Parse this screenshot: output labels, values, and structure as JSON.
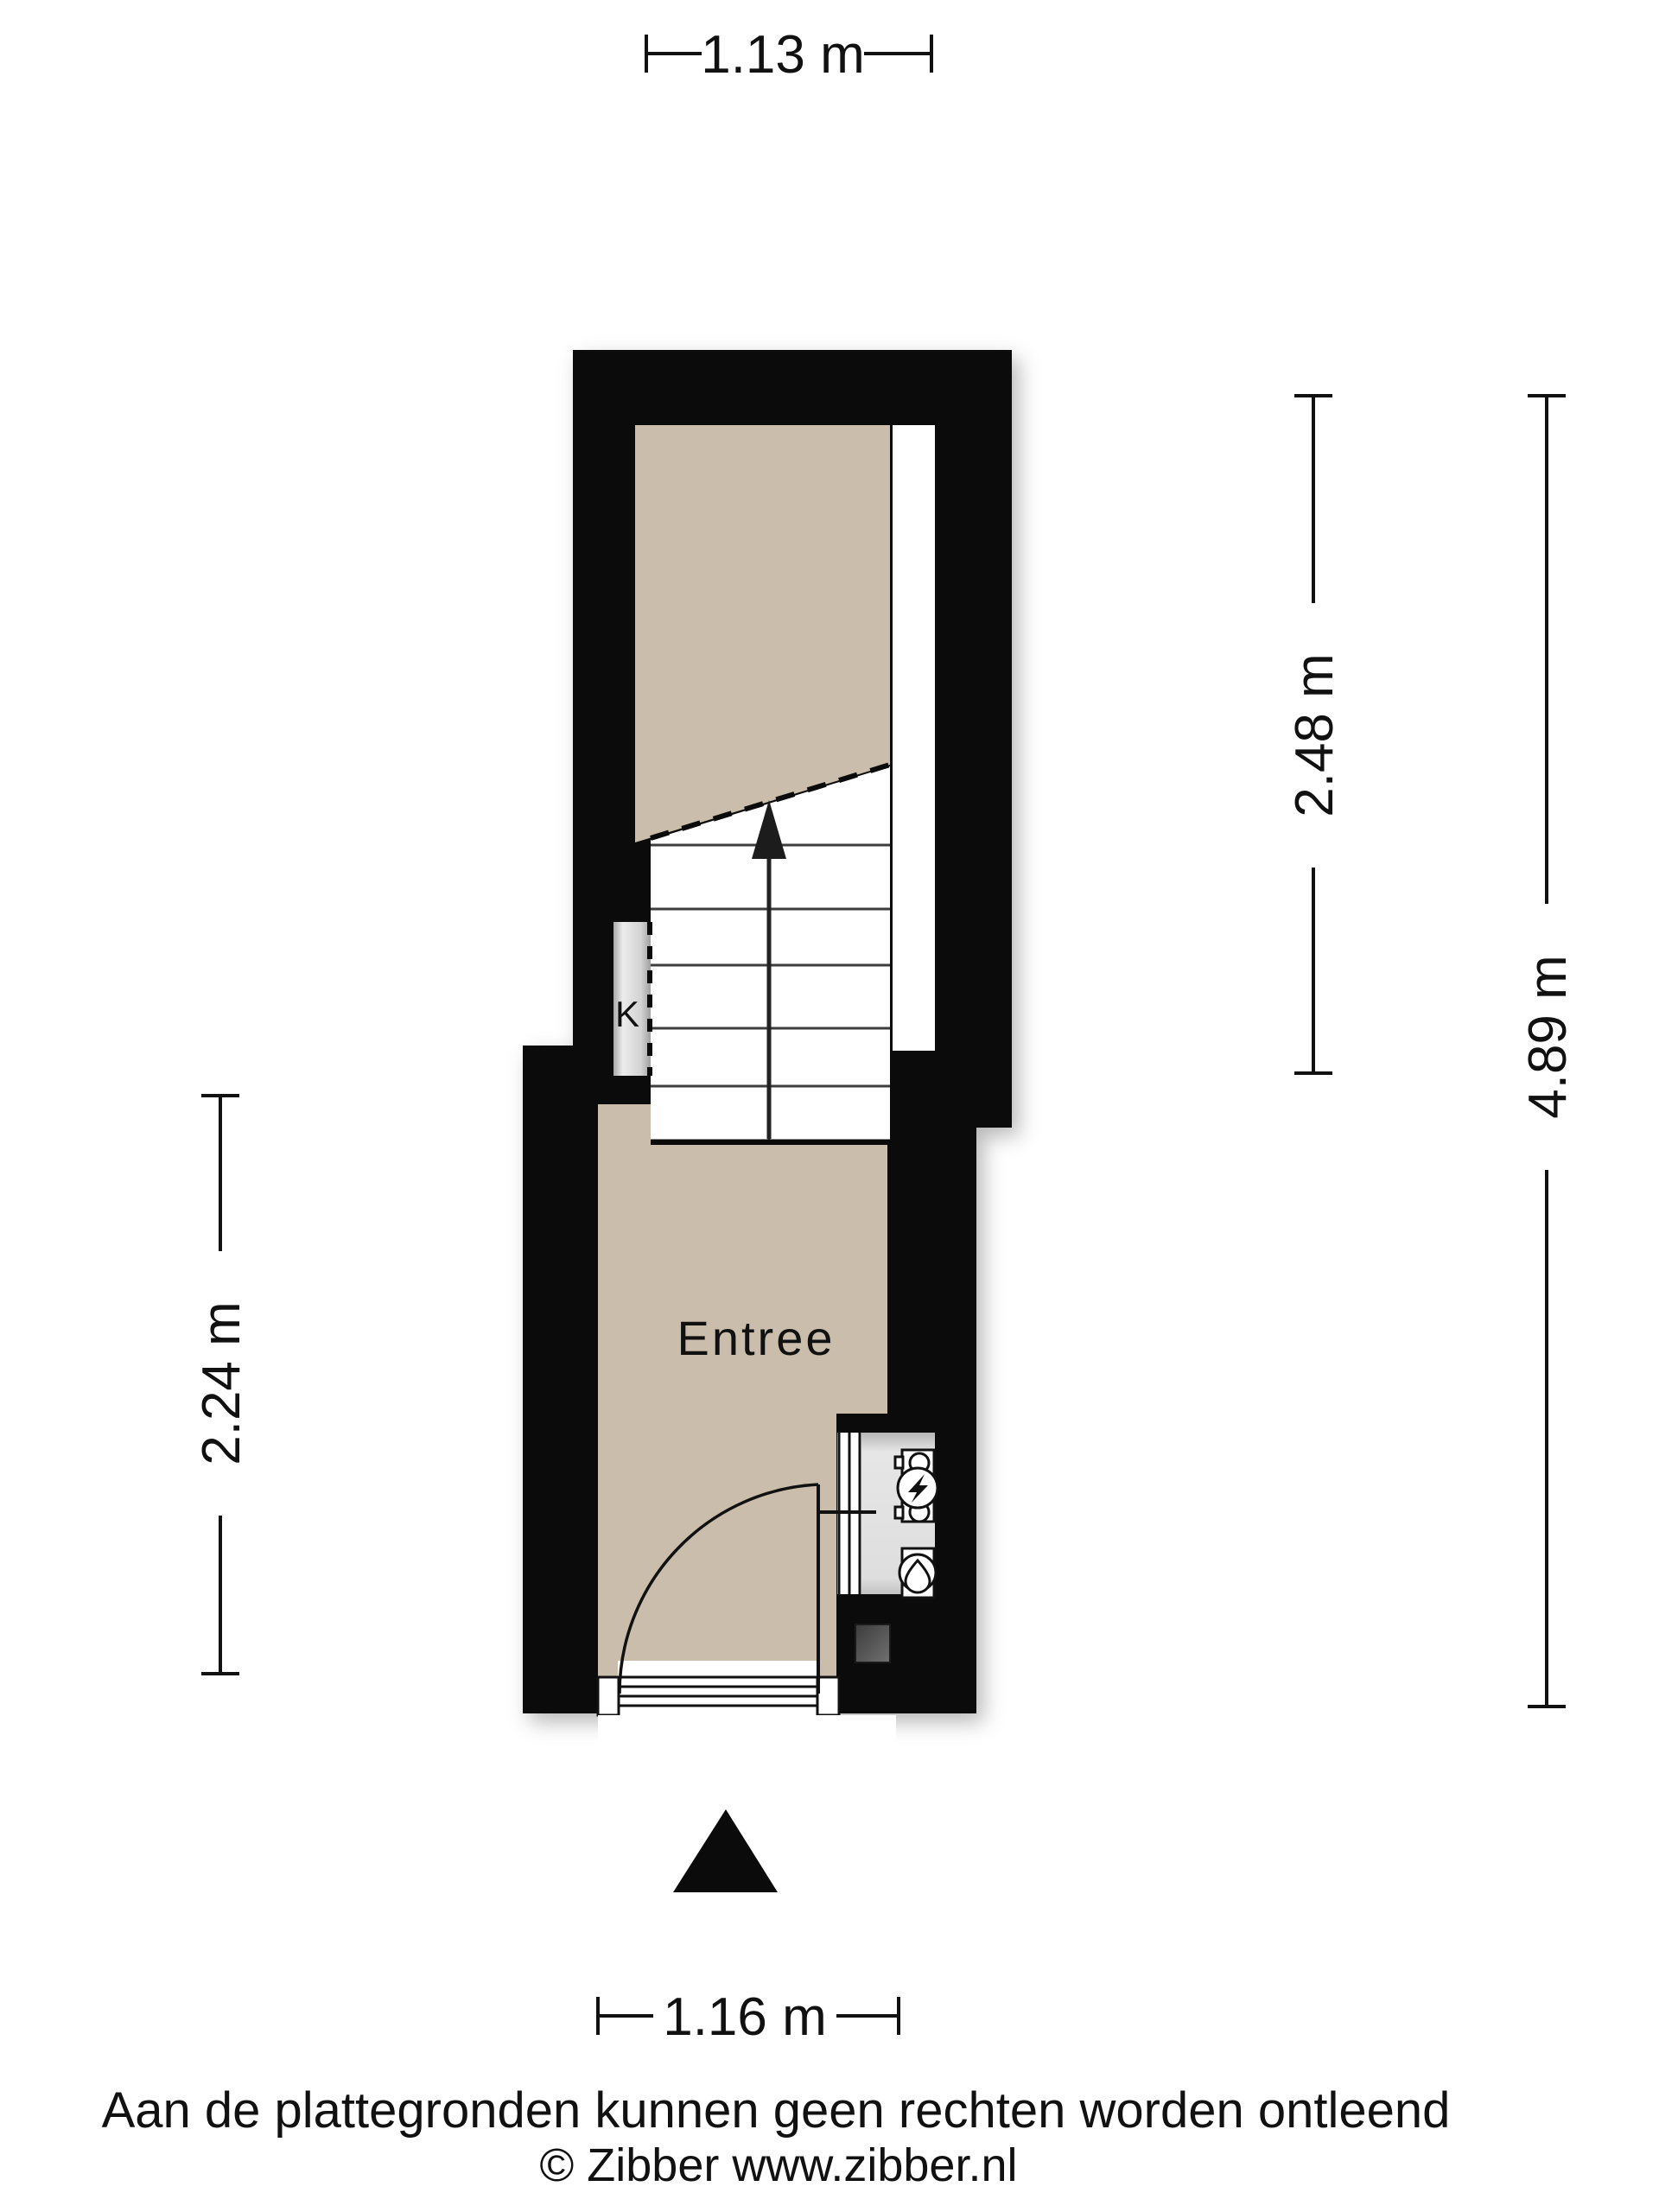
{
  "plan": {
    "rooms": {
      "entree": {
        "label": "Entree"
      },
      "closet": {
        "label": "K"
      }
    },
    "icons": {
      "stairs_direction": "up-arrow-icon",
      "entrance_marker": "entrance-triangle-icon",
      "electricity_meter": "electricity-meter-icon",
      "water_meter": "water-meter-icon"
    },
    "colors": {
      "wall": "#0b0b0b",
      "floor": "#cabdab",
      "closet_gray": "#d6d6d6",
      "meter_niche": "#e3e3e3",
      "doormat_gray": "#4f4f4f",
      "line": "#111111",
      "background": "#ffffff"
    }
  },
  "dimensions": {
    "top": "1.13 m",
    "right_upper": "2.48 m",
    "right_total": "4.89 m",
    "left": "2.24 m",
    "bottom": "1.16 m"
  },
  "footer": {
    "disclaimer": "Aan de plattegronden kunnen geen rechten worden ontleend",
    "copyright": "© Zibber www.zibber.nl"
  }
}
